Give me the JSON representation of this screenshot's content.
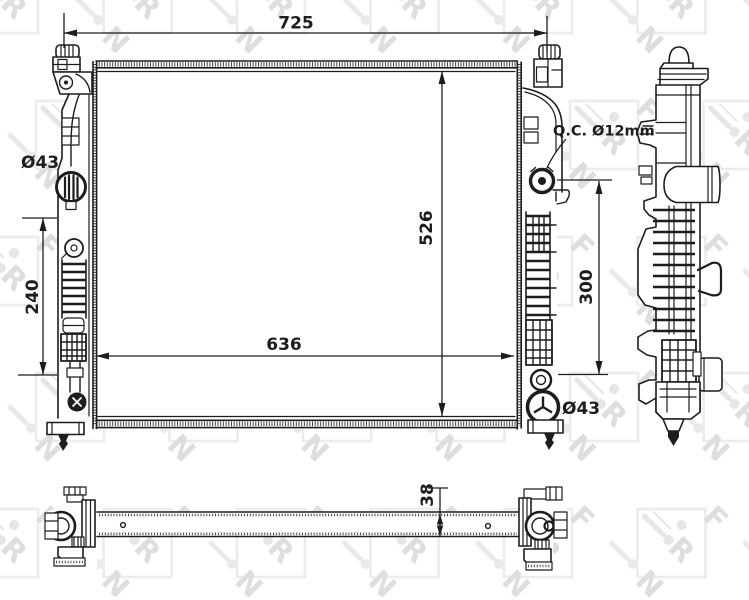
{
  "drawing": {
    "dimensions": {
      "overall_width": "725",
      "overall_height": "526",
      "core_width": "636",
      "left_port_span": "240",
      "right_port_span": "300",
      "core_thickness": "38",
      "inlet_port_diameter": "Ø43",
      "outlet_port_diameter": "Ø43",
      "quick_connector_note": "Q.C. Ø12mm"
    },
    "watermark_letters": [
      "N",
      "R",
      "F"
    ],
    "colors": {
      "ink": "#1d1d1d",
      "watermark_frame": "#ececec",
      "watermark_motif": "#e6e6e6",
      "watermark_text": "#dedede",
      "background": "#ffffff"
    }
  }
}
